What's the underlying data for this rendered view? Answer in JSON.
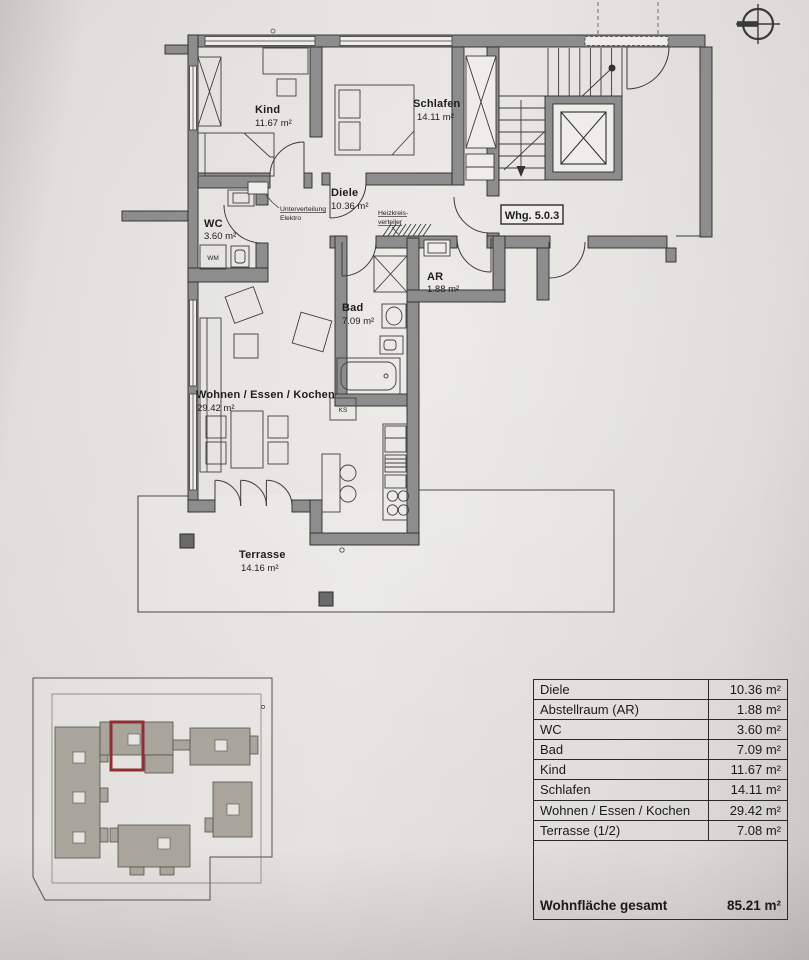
{
  "unit": {
    "label": "Whg. 5.0.3"
  },
  "colors": {
    "wall": "#8d8d8d",
    "line": "#2b2b2b",
    "paper": "#e2e0dc",
    "highlight_red": "#8e2f33",
    "site_building": "#a9a59c"
  },
  "rooms": {
    "kind": {
      "name": "Kind",
      "area": "11.67 m²"
    },
    "schlafen": {
      "name": "Schlafen",
      "area": "14.11 m²"
    },
    "diele": {
      "name": "Diele",
      "area": "10.36 m²"
    },
    "wc": {
      "name": "WC",
      "area": "3.60 m²"
    },
    "bad": {
      "name": "Bad",
      "area": "7.09 m²"
    },
    "ar": {
      "name": "AR",
      "area": "1.88 m²"
    },
    "wohnen": {
      "name": "Wohnen / Essen / Kochen",
      "area": "29.42 m²"
    },
    "terrasse": {
      "name": "Terrasse",
      "area": "14.16 m²"
    }
  },
  "annotations": {
    "unterverteilung_line1": "Unterverteilung",
    "unterverteilung_line2": "Elektro",
    "heizkreis_line1": "Heizkreis-",
    "heizkreis_line2": "verteiler",
    "wm": "WM",
    "ks": "KS"
  },
  "table": {
    "rows": [
      {
        "label": "Diele",
        "value": "10.36 m²"
      },
      {
        "label": "Abstellraum (AR)",
        "value": "1.88 m²"
      },
      {
        "label": "WC",
        "value": "3.60 m²"
      },
      {
        "label": "Bad",
        "value": "7.09 m²"
      },
      {
        "label": "Kind",
        "value": "11.67 m²"
      },
      {
        "label": "Schlafen",
        "value": "14.11 m²"
      },
      {
        "label": "Wohnen / Essen / Kochen",
        "value": "29.42 m²"
      },
      {
        "label": "Terrasse (1/2)",
        "value": "7.08 m²"
      }
    ],
    "total": {
      "label": "Wohnfläche gesamt",
      "value": "85.21 m²"
    }
  }
}
